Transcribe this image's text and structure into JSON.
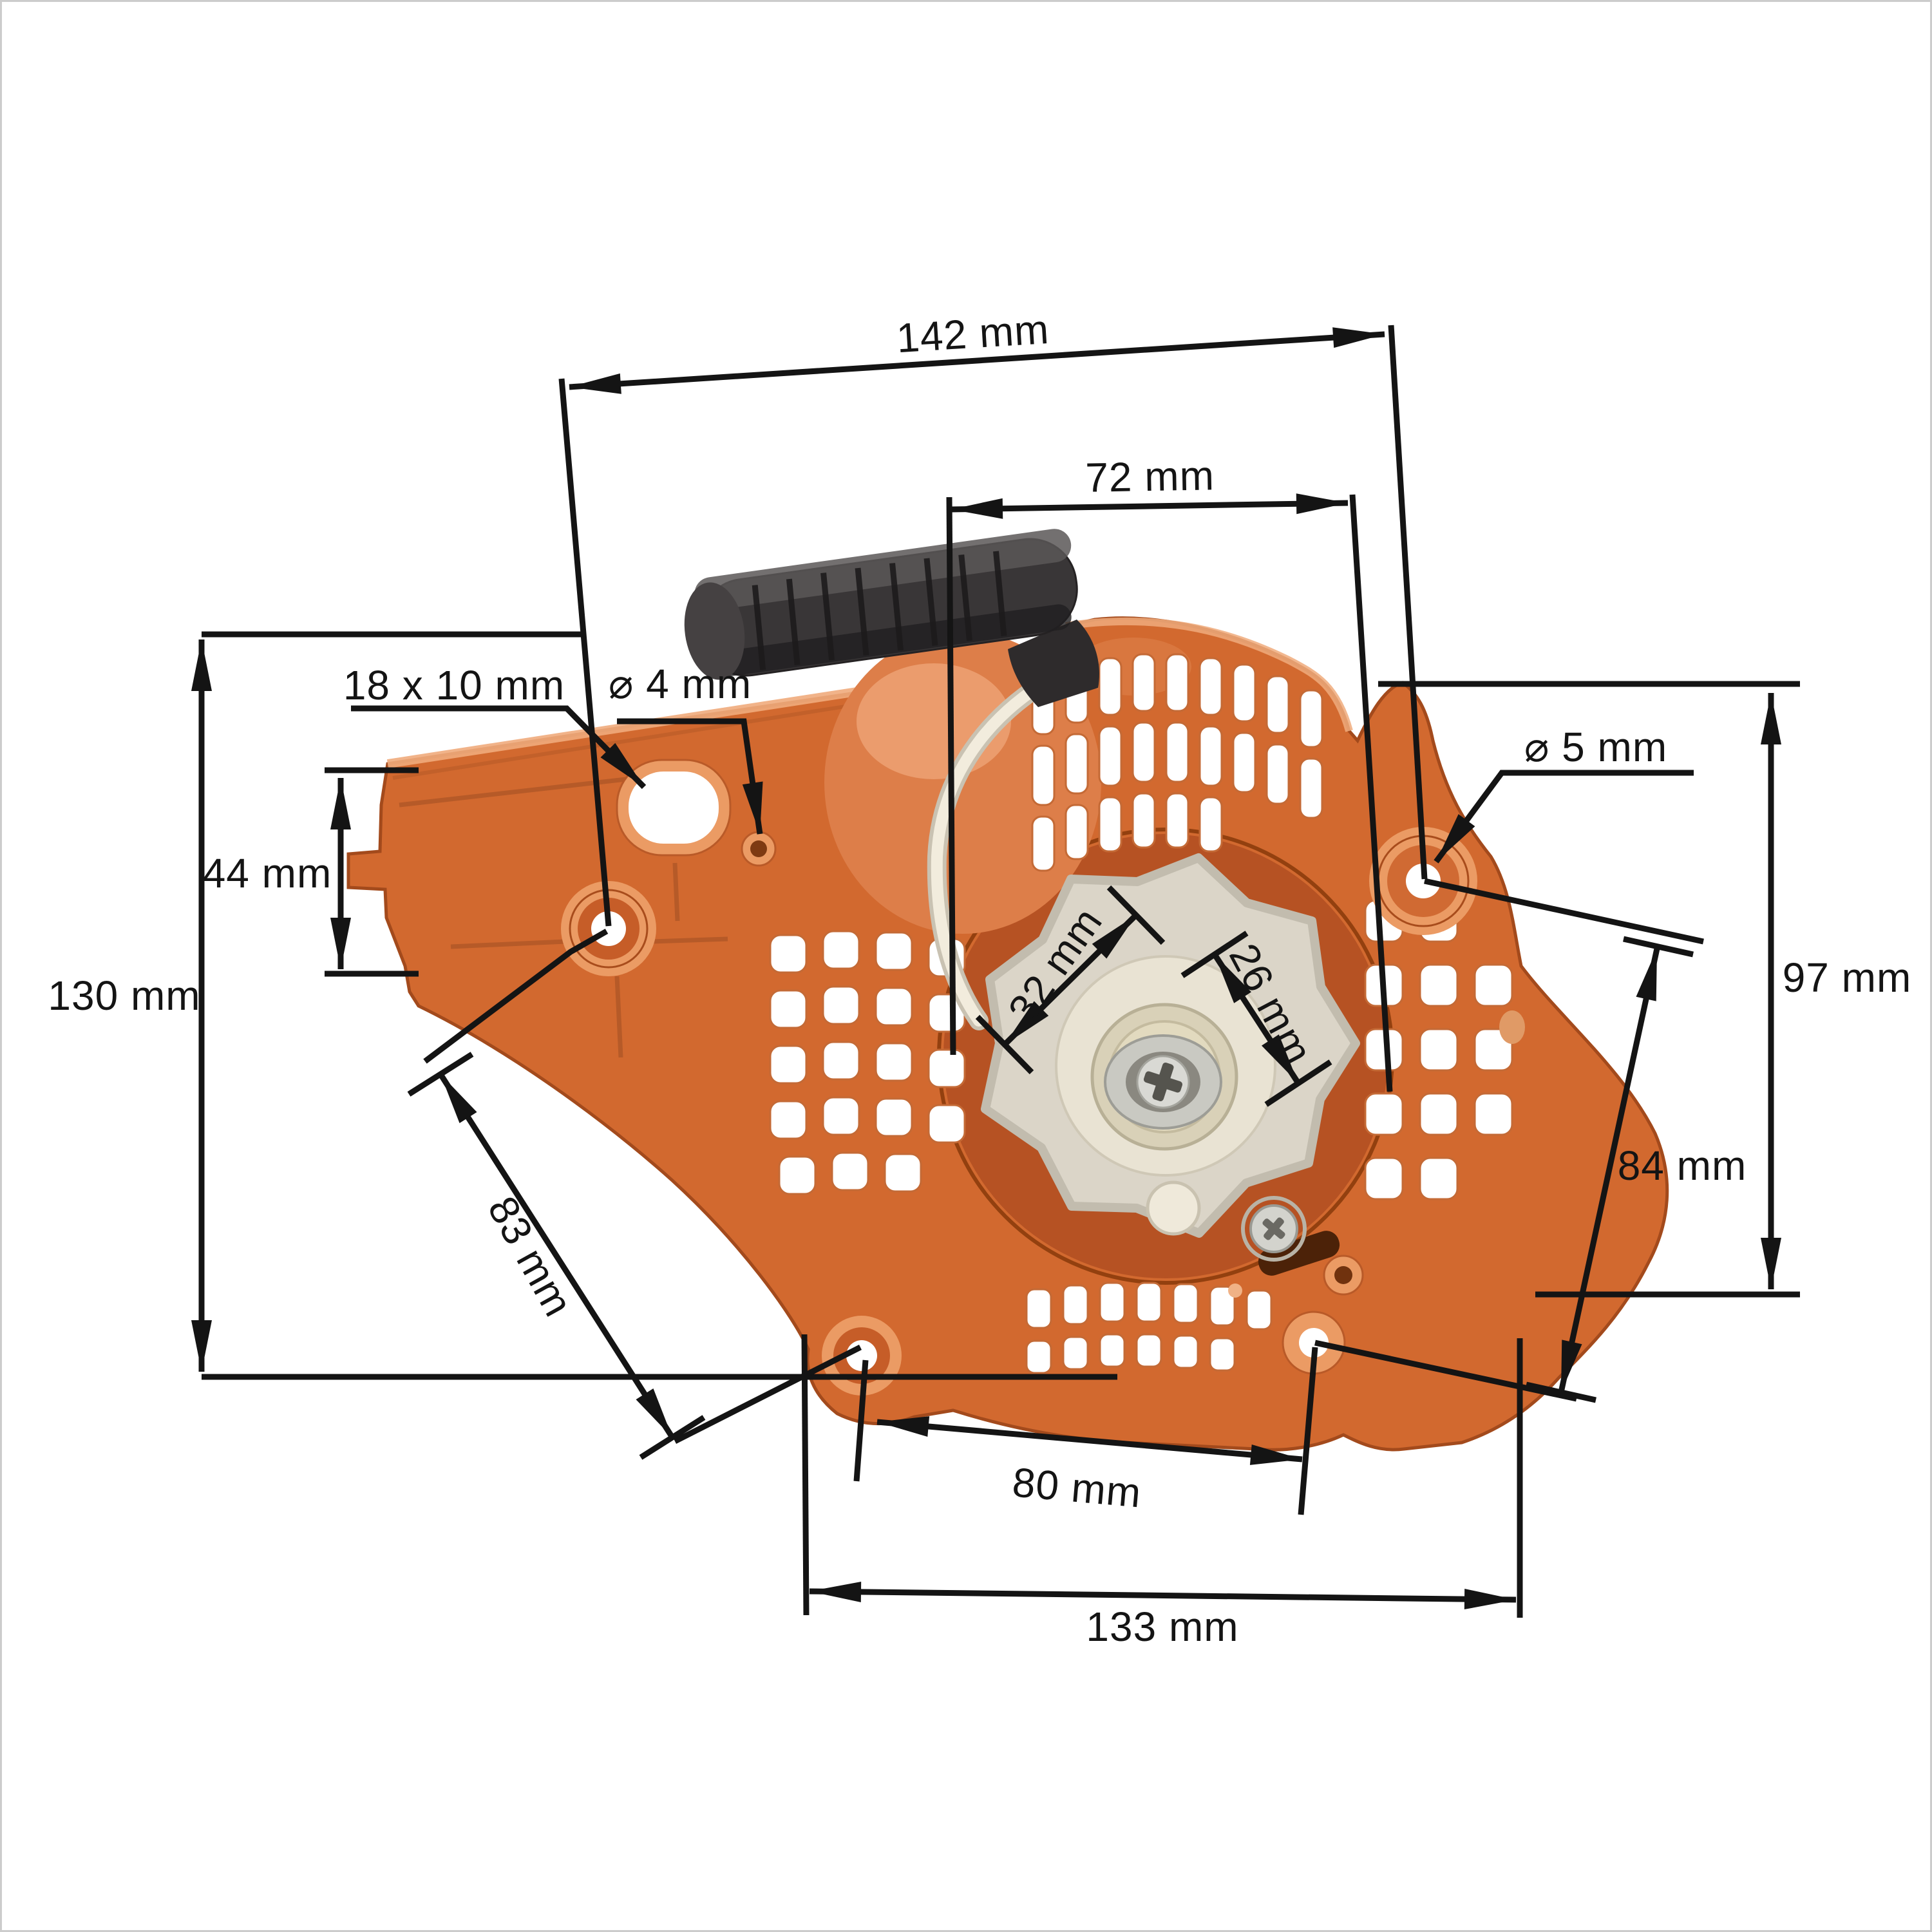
{
  "figure": {
    "type": "dimensioned-product-photo",
    "subject": "chainsaw recoil starter cover with pull handle, viewed from inside",
    "units": "mm"
  },
  "labels": {
    "d142": "142 mm",
    "d72": "72 mm",
    "slot": "18 x 10 mm",
    "d4": "⌀ 4 mm",
    "d5": "⌀ 5 mm",
    "d44": "44 mm",
    "d130": "130 mm",
    "d32": "32 mm",
    "d26": "26 mm",
    "d97": "97 mm",
    "d84": "84 mm",
    "d83": "83 mm",
    "d80": "80 mm",
    "d133": "133 mm"
  },
  "dimensions_mm": {
    "overall_width": 142,
    "handle_to_right_hole": 72,
    "mount_slot": "18 x 10",
    "small_hole_diameter": 4,
    "top_right_hole_diameter": 5,
    "left_flange_height": 44,
    "overall_height": 130,
    "pulley_outer": 32,
    "pulley_hub": 26,
    "right_side_height": 97,
    "right_hole_span": 84,
    "left_hole_span": 83,
    "bottom_hole_span": 80,
    "bottom_width": 133
  },
  "colors": {
    "housing_orange": "#d2692f",
    "housing_light": "#eb9b64",
    "housing_dark": "#a84c1c",
    "recess": "#b65223",
    "pulley_gray": "#dbd5c8",
    "pulley_cream": "#e9e3d3",
    "screw_silver": "#d9d9d4",
    "handle_black": "#393637",
    "rope_white": "#f2ecdd",
    "dimension_line": "#141414",
    "background": "#ffffff"
  }
}
